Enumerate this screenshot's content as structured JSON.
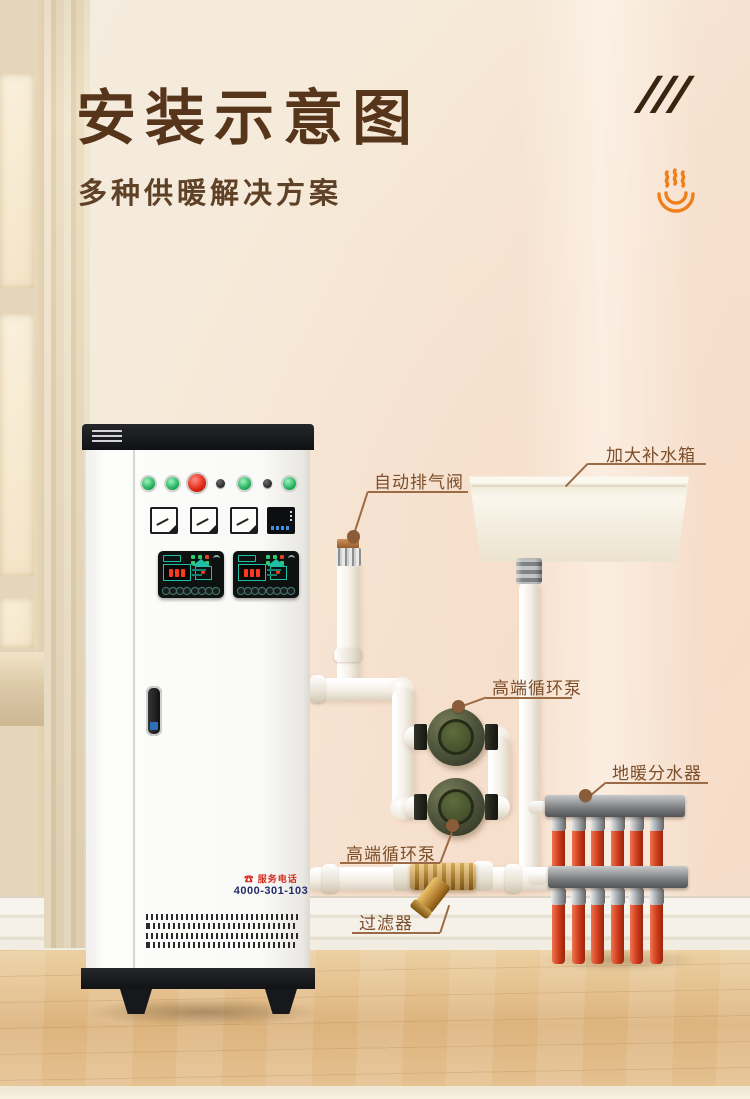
{
  "header": {
    "title": "安装示意图",
    "subtitle": "多种供暖解决方案",
    "slashes": "///"
  },
  "callouts": {
    "air_vent": "自动排气阀",
    "tank": "加大补水箱",
    "pump_upper": "高端循环泵",
    "pump_lower": "高端循环泵",
    "manifold": "地暖分水器",
    "filter": "过滤器"
  },
  "cabinet": {
    "service_label": "服务电话",
    "service_phone": "4000-301-103"
  },
  "colors": {
    "title_brown": "#56351a",
    "label_brown": "#7c4e2a",
    "accent_orange": "#ee7f1b",
    "pump_green": "#46522c",
    "manifold_red": "#cc3a1b"
  }
}
